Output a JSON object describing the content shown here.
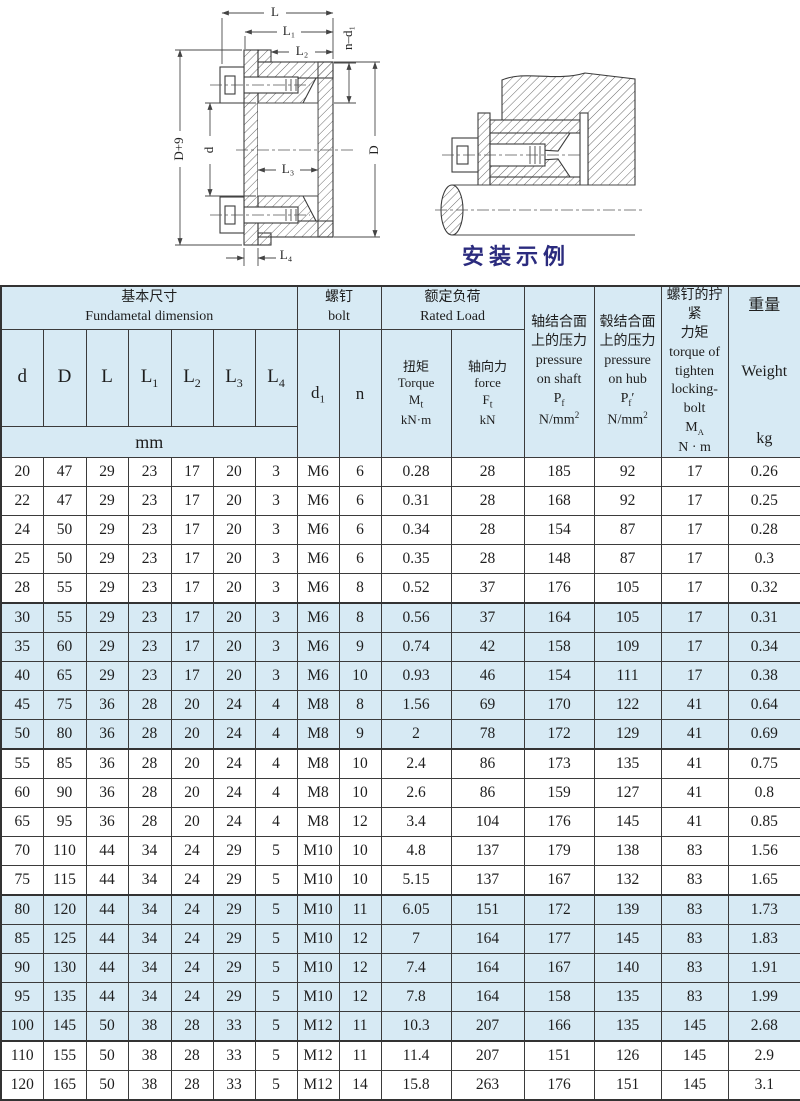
{
  "colors": {
    "band": "#d7eaf4",
    "border": "#3b3b3b",
    "caption": "#2b2b7e",
    "paper": "#ffffff"
  },
  "drawings": {
    "caption": "安装示例",
    "labels": {
      "L": "L",
      "L1": "L₁",
      "L2": "L₂",
      "L3": "L₃",
      "L4": "L₄",
      "nd1": "n–d₁",
      "Dplus9": "D+9",
      "d": "d",
      "D": "D"
    }
  },
  "table": {
    "group_headers": {
      "basic": {
        "zh": "基本尺寸",
        "en": "Fundametal dimension"
      },
      "bolt": {
        "zh": "螺钉",
        "en": "bolt"
      },
      "rated": {
        "zh": "额定负荷",
        "en": "Rated Load"
      }
    },
    "dim_cols": [
      {
        "b": "d",
        "s": ""
      },
      {
        "b": "D",
        "s": ""
      },
      {
        "b": "L",
        "s": ""
      },
      {
        "b": "L",
        "s": "1"
      },
      {
        "b": "L",
        "s": "2"
      },
      {
        "b": "L",
        "s": "3"
      },
      {
        "b": "L",
        "s": "4"
      }
    ],
    "unit_row": "mm",
    "bolt_cols": {
      "d1b": "d",
      "d1s": "1",
      "n": "n"
    },
    "torque": {
      "zh": "扭矩",
      "en": "Torque",
      "sym": "M",
      "sub": "t",
      "unit": "kN·m"
    },
    "force": {
      "zh": "轴向力",
      "en": "force",
      "sym": "F",
      "sub": "t",
      "unit": "kN"
    },
    "p_shaft": {
      "zh1": "轴结合面",
      "zh2": "上的压力",
      "en1": "pressure",
      "en2": "on shaft",
      "sym": "P",
      "sub": "f",
      "prime": "",
      "unitb": "N/mm",
      "unitp": "2"
    },
    "p_hub": {
      "zh1": "毂结合面",
      "zh2": "上的压力",
      "en1": "pressure",
      "en2": "on hub",
      "sym": "P",
      "sub": "f",
      "prime": "′",
      "unitb": "N/mm",
      "unitp": "2"
    },
    "ma": {
      "zh1": "螺钉的拧紧",
      "zh2": "力矩",
      "en1": "torque of",
      "en2": "tighten",
      "en3": "locking-bolt",
      "sym": "M",
      "sub": "A",
      "unit": "N · m"
    },
    "weight": {
      "zh": "重量",
      "en": "Weight",
      "unit": "kg"
    },
    "rows": [
      [
        "20",
        "47",
        "29",
        "23",
        "17",
        "20",
        "3",
        "M6",
        "6",
        "0.28",
        "28",
        "185",
        "92",
        "17",
        "0.26"
      ],
      [
        "22",
        "47",
        "29",
        "23",
        "17",
        "20",
        "3",
        "M6",
        "6",
        "0.31",
        "28",
        "168",
        "92",
        "17",
        "0.25"
      ],
      [
        "24",
        "50",
        "29",
        "23",
        "17",
        "20",
        "3",
        "M6",
        "6",
        "0.34",
        "28",
        "154",
        "87",
        "17",
        "0.28"
      ],
      [
        "25",
        "50",
        "29",
        "23",
        "17",
        "20",
        "3",
        "M6",
        "6",
        "0.35",
        "28",
        "148",
        "87",
        "17",
        "0.3"
      ],
      [
        "28",
        "55",
        "29",
        "23",
        "17",
        "20",
        "3",
        "M6",
        "8",
        "0.52",
        "37",
        "176",
        "105",
        "17",
        "0.32"
      ],
      [
        "30",
        "55",
        "29",
        "23",
        "17",
        "20",
        "3",
        "M6",
        "8",
        "0.56",
        "37",
        "164",
        "105",
        "17",
        "0.31"
      ],
      [
        "35",
        "60",
        "29",
        "23",
        "17",
        "20",
        "3",
        "M6",
        "9",
        "0.74",
        "42",
        "158",
        "109",
        "17",
        "0.34"
      ],
      [
        "40",
        "65",
        "29",
        "23",
        "17",
        "20",
        "3",
        "M6",
        "10",
        "0.93",
        "46",
        "154",
        "111",
        "17",
        "0.38"
      ],
      [
        "45",
        "75",
        "36",
        "28",
        "20",
        "24",
        "4",
        "M8",
        "8",
        "1.56",
        "69",
        "170",
        "122",
        "41",
        "0.64"
      ],
      [
        "50",
        "80",
        "36",
        "28",
        "20",
        "24",
        "4",
        "M8",
        "9",
        "2",
        "78",
        "172",
        "129",
        "41",
        "0.69"
      ],
      [
        "55",
        "85",
        "36",
        "28",
        "20",
        "24",
        "4",
        "M8",
        "10",
        "2.4",
        "86",
        "173",
        "135",
        "41",
        "0.75"
      ],
      [
        "60",
        "90",
        "36",
        "28",
        "20",
        "24",
        "4",
        "M8",
        "10",
        "2.6",
        "86",
        "159",
        "127",
        "41",
        "0.8"
      ],
      [
        "65",
        "95",
        "36",
        "28",
        "20",
        "24",
        "4",
        "M8",
        "12",
        "3.4",
        "104",
        "176",
        "145",
        "41",
        "0.85"
      ],
      [
        "70",
        "110",
        "44",
        "34",
        "24",
        "29",
        "5",
        "M10",
        "10",
        "4.8",
        "137",
        "179",
        "138",
        "83",
        "1.56"
      ],
      [
        "75",
        "115",
        "44",
        "34",
        "24",
        "29",
        "5",
        "M10",
        "10",
        "5.15",
        "137",
        "167",
        "132",
        "83",
        "1.65"
      ],
      [
        "80",
        "120",
        "44",
        "34",
        "24",
        "29",
        "5",
        "M10",
        "11",
        "6.05",
        "151",
        "172",
        "139",
        "83",
        "1.73"
      ],
      [
        "85",
        "125",
        "44",
        "34",
        "24",
        "29",
        "5",
        "M10",
        "12",
        "7",
        "164",
        "177",
        "145",
        "83",
        "1.83"
      ],
      [
        "90",
        "130",
        "44",
        "34",
        "24",
        "29",
        "5",
        "M10",
        "12",
        "7.4",
        "164",
        "167",
        "140",
        "83",
        "1.91"
      ],
      [
        "95",
        "135",
        "44",
        "34",
        "24",
        "29",
        "5",
        "M10",
        "12",
        "7.8",
        "164",
        "158",
        "135",
        "83",
        "1.99"
      ],
      [
        "100",
        "145",
        "50",
        "38",
        "28",
        "33",
        "5",
        "M12",
        "11",
        "10.3",
        "207",
        "166",
        "135",
        "145",
        "2.68"
      ],
      [
        "110",
        "155",
        "50",
        "38",
        "28",
        "33",
        "5",
        "M12",
        "11",
        "11.4",
        "207",
        "151",
        "126",
        "145",
        "2.9"
      ],
      [
        "120",
        "165",
        "50",
        "38",
        "28",
        "33",
        "5",
        "M12",
        "14",
        "15.8",
        "263",
        "176",
        "151",
        "145",
        "3.1"
      ]
    ],
    "shaded_rows": [
      5,
      6,
      7,
      8,
      9,
      15,
      16,
      17,
      18,
      19
    ],
    "group_starts": [
      5,
      10,
      15,
      20
    ]
  }
}
